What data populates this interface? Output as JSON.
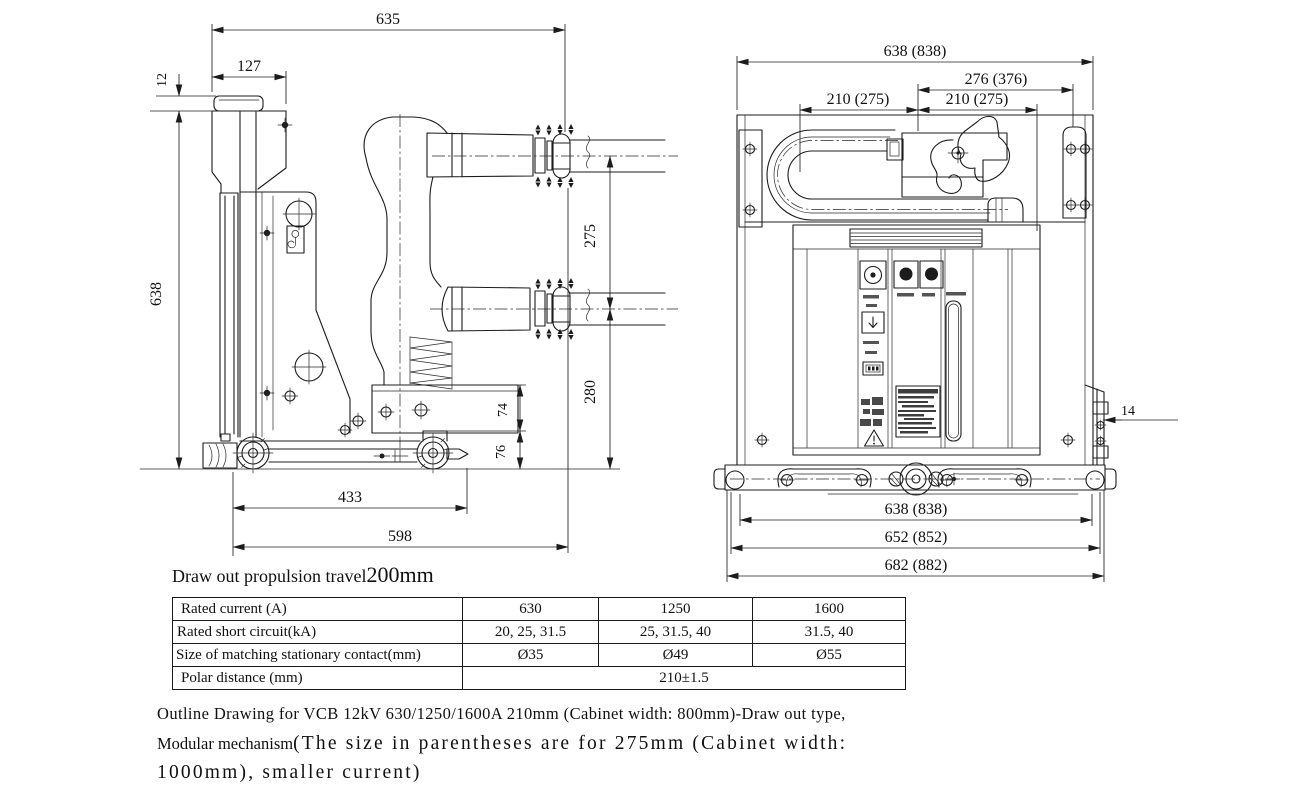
{
  "side_view": {
    "dims": {
      "total_depth": "635",
      "cap_depth": "127",
      "cap_offset": "12",
      "height": "638",
      "upper_span": "275",
      "lower_span": "280",
      "box_height": "74",
      "base_height": "76",
      "base_length": "433",
      "frame_depth": "598"
    }
  },
  "front_view": {
    "dims": {
      "overall_width": "638 (838)",
      "lift_offset": "276 (376)",
      "pitch_left": "210 (275)",
      "pitch_right": "210 (275)",
      "rail_width": "14",
      "base_width_inner": "638 (838)",
      "base_width_mid": "652 (852)",
      "base_width_outer": "682 (882)"
    }
  },
  "note": {
    "prefix": "Draw out propulsion travel",
    "value": "200mm"
  },
  "table": {
    "rows": [
      {
        "label": "Rated current (A)",
        "values": [
          "630",
          "1250",
          "1600"
        ]
      },
      {
        "label": "Rated short circuit(kA)",
        "values": [
          "20, 25, 31.5",
          "25, 31.5, 40",
          "31.5, 40"
        ]
      },
      {
        "label": "Size of matching stationary contact(mm)",
        "values": [
          "Ø35",
          "Ø49",
          "Ø55"
        ]
      },
      {
        "label": "Polar distance  (mm)",
        "merged_value": "210±1.5"
      }
    ]
  },
  "caption": {
    "line1": "Outline Drawing for VCB 12kV  630/1250/1600A 210mm (Cabinet width: 800mm)-Draw out type,",
    "line2_prefix": "Modular mechanism",
    "line2_rest": "(The size in parentheses are for 275mm (Cabinet width:",
    "line3": "1000mm), smaller current)"
  }
}
